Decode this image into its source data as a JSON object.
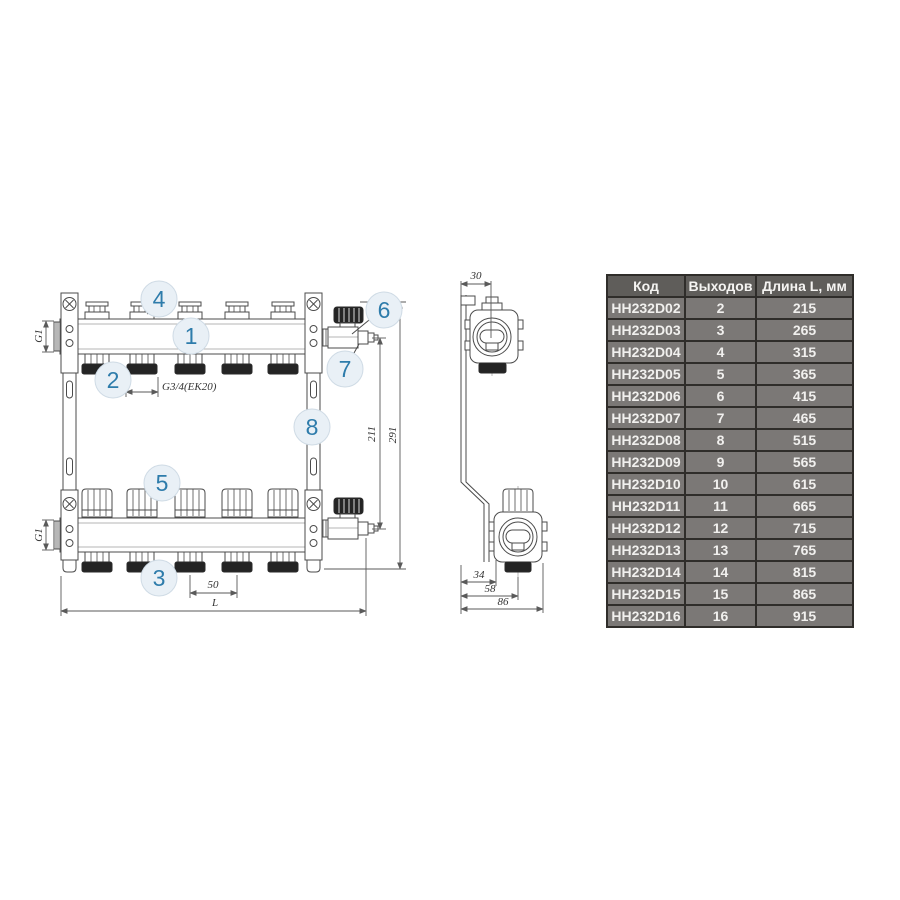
{
  "drawing": {
    "callouts": [
      "1",
      "2",
      "3",
      "4",
      "5",
      "6",
      "7",
      "8"
    ],
    "dims": {
      "g1": "G1",
      "thread": "G3/4(EK20)",
      "spacing": "50",
      "length": "L",
      "valve_height": "211",
      "total_height": "291",
      "depth": "30",
      "d34": "34",
      "d58": "58",
      "d86": "86"
    },
    "colors": {
      "line": "#4b4b4b",
      "callout_text": "#2e7cab",
      "callout_fill": "#e9f0f6"
    }
  },
  "table": {
    "headers": {
      "code": "Код",
      "outputs": "Выходов",
      "length": "Длина L, мм"
    },
    "header_bg": "#5f5d5a",
    "row_bg": "#7b7876",
    "border_color": "#2f2d2a",
    "rows": [
      {
        "code": "HH232D02",
        "outputs": "2",
        "length": "215"
      },
      {
        "code": "HH232D03",
        "outputs": "3",
        "length": "265"
      },
      {
        "code": "HH232D04",
        "outputs": "4",
        "length": "315"
      },
      {
        "code": "HH232D05",
        "outputs": "5",
        "length": "365"
      },
      {
        "code": "HH232D06",
        "outputs": "6",
        "length": "415"
      },
      {
        "code": "HH232D07",
        "outputs": "7",
        "length": "465"
      },
      {
        "code": "HH232D08",
        "outputs": "8",
        "length": "515"
      },
      {
        "code": "HH232D09",
        "outputs": "9",
        "length": "565"
      },
      {
        "code": "HH232D10",
        "outputs": "10",
        "length": "615"
      },
      {
        "code": "HH232D11",
        "outputs": "11",
        "length": "665"
      },
      {
        "code": "HH232D12",
        "outputs": "12",
        "length": "715"
      },
      {
        "code": "HH232D13",
        "outputs": "13",
        "length": "765"
      },
      {
        "code": "HH232D14",
        "outputs": "14",
        "length": "815"
      },
      {
        "code": "HH232D15",
        "outputs": "15",
        "length": "865"
      },
      {
        "code": "HH232D16",
        "outputs": "16",
        "length": "915"
      }
    ]
  }
}
